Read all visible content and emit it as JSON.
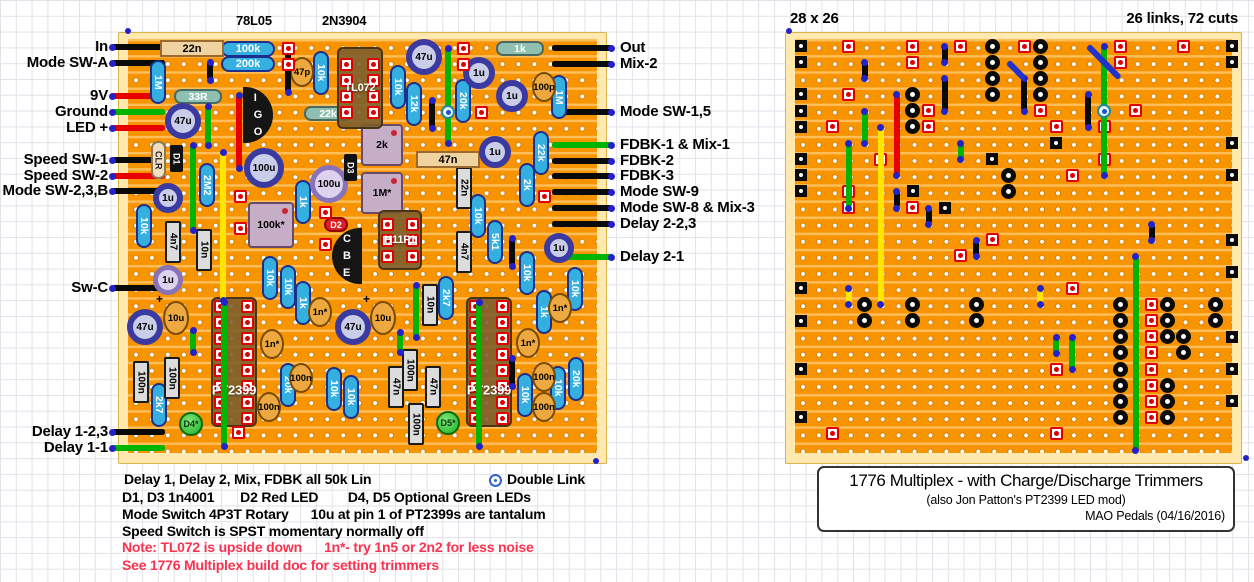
{
  "header": {
    "ic_label_1": "78L05",
    "ic_label_2": "2N3904",
    "board_size": "28 x 26",
    "links_cuts": "26 links, 72 cuts"
  },
  "left_labels": [
    {
      "text": "In",
      "y": 47,
      "color": "black"
    },
    {
      "text": "Mode SW-A",
      "y": 63,
      "color": "black"
    },
    {
      "text": "9V",
      "y": 96,
      "color": "red"
    },
    {
      "text": "Ground",
      "y": 112,
      "color": "green"
    },
    {
      "text": "LED +",
      "y": 128,
      "color": "red"
    },
    {
      "text": "Speed SW-1",
      "y": 160,
      "color": "black"
    },
    {
      "text": "Speed SW-2",
      "y": 176,
      "color": "red"
    },
    {
      "text": "Mode SW-2,3,B",
      "y": 191,
      "color": "black"
    },
    {
      "text": "Sw-C",
      "y": 288,
      "color": "black"
    },
    {
      "text": "Delay 1-2,3",
      "y": 432,
      "color": "black"
    },
    {
      "text": "Delay 1-1",
      "y": 448,
      "color": "green"
    }
  ],
  "right_labels": [
    {
      "text": "Out",
      "y": 48,
      "color": "black"
    },
    {
      "text": "Mix-2",
      "y": 64,
      "color": "black"
    },
    {
      "text": "Mode SW-1,5",
      "y": 112,
      "color": "black"
    },
    {
      "text": "FDBK-1 & Mix-1",
      "y": 145,
      "color": "green"
    },
    {
      "text": "FDBK-2",
      "y": 161,
      "color": "black"
    },
    {
      "text": "FDBK-3",
      "y": 176,
      "color": "black"
    },
    {
      "text": "Mode SW-9",
      "y": 192,
      "color": "black"
    },
    {
      "text": "Mode SW-8 & Mix-3",
      "y": 208,
      "color": "black"
    },
    {
      "text": "Delay 2-2,3",
      "y": 224,
      "color": "black"
    },
    {
      "text": "Delay 2-1",
      "y": 257,
      "color": "green"
    }
  ],
  "notes": {
    "line1": "Delay 1, Delay 2, Mix, FDBK all 50k Lin",
    "legend_double_link": "Double Link",
    "line2": "D1, D3 1n4001       D2 Red LED        D4, D5 Optional Green LEDs",
    "line3": "Mode Switch 4P3T Rotary      10u at pin 1 of PT2399s are tantalum",
    "line4": "Speed Switch is SPST momentary normally off",
    "line5": "Note: TL072 is upside down      1n*- try 1n5 or 2n2 for less noise",
    "line6": "See 1776 Multiplex build doc for setting trimmers"
  },
  "caption": {
    "title": "1776 Multiplex - with Charge/Discharge Trimmers",
    "subtitle": "(also Jon Patton's PT2399 LED mod)",
    "credit": "MAO Pedals (04/16/2016)"
  },
  "colors": {
    "board_margin": "#FFE9AE",
    "strip": "#F79400",
    "strip_gap": "#FFBE5C",
    "wire_black": "#0A0A0A",
    "wire_red": "#E80000",
    "wire_green": "#00B400",
    "wire_yellow": "#FFE500",
    "wire_blue": "#2233CC",
    "note_red": "#FA3250"
  },
  "left_board": {
    "x": 118,
    "y": 32,
    "w": 487,
    "h": 430,
    "components": [
      [
        "rh",
        "100k",
        248,
        49
      ],
      [
        "rh",
        "200k",
        248,
        64
      ],
      [
        "rg",
        "33R",
        198,
        96
      ],
      [
        "rg",
        "22k",
        328,
        113
      ],
      [
        "rg",
        "1k",
        520,
        48
      ],
      [
        "rv",
        "1M",
        158,
        82
      ],
      [
        "rv",
        "10k",
        321,
        73
      ],
      [
        "rv",
        "10k",
        398,
        87
      ],
      [
        "rv",
        "12k",
        414,
        104
      ],
      [
        "rv",
        "20k",
        463,
        101
      ],
      [
        "rv",
        "1M",
        559,
        97
      ],
      [
        "rv",
        "2M2",
        207,
        185
      ],
      [
        "rv",
        "10k",
        144,
        226
      ],
      [
        "rv",
        "1k",
        303,
        202
      ],
      [
        "rv",
        "22k",
        541,
        153
      ],
      [
        "rv",
        "2k",
        527,
        185
      ],
      [
        "rv",
        "10k",
        478,
        216
      ],
      [
        "rv",
        "5k1",
        495,
        242
      ],
      [
        "rv",
        "10k",
        270,
        278
      ],
      [
        "rv",
        "10k",
        288,
        287
      ],
      [
        "rv",
        "1k",
        303,
        303
      ],
      [
        "rv",
        "2k7",
        446,
        298
      ],
      [
        "rv",
        "10k",
        527,
        273
      ],
      [
        "rv",
        "1k",
        544,
        312
      ],
      [
        "rv",
        "10k",
        575,
        289
      ],
      [
        "rv",
        "20k",
        288,
        385
      ],
      [
        "rv",
        "10k",
        334,
        389
      ],
      [
        "rv",
        "10k",
        351,
        397
      ],
      [
        "rv",
        "2k7",
        159,
        405
      ],
      [
        "rv",
        "10k",
        525,
        395
      ],
      [
        "rv",
        "10k",
        558,
        388
      ],
      [
        "rv",
        "20k",
        576,
        379
      ],
      [
        "bx",
        "4n7",
        173,
        242
      ],
      [
        "bx",
        "10n",
        204,
        250
      ],
      [
        "bx",
        "22n",
        464,
        188
      ],
      [
        "bx",
        "4n7",
        464,
        252
      ],
      [
        "bx",
        "10n",
        430,
        305
      ],
      [
        "bx",
        "100n",
        141,
        382
      ],
      [
        "bx",
        "100n",
        172,
        378
      ],
      [
        "bx",
        "47n",
        396,
        387
      ],
      [
        "bx",
        "47n",
        433,
        387
      ],
      [
        "bx",
        "100n",
        410,
        370
      ],
      [
        "bx",
        "100n",
        416,
        424
      ],
      [
        "bt",
        "22n",
        192,
        48
      ],
      [
        "bt",
        "47n",
        448,
        159
      ],
      [
        "dc",
        "47p",
        302,
        72
      ],
      [
        "dc",
        "100p",
        544,
        87
      ],
      [
        "dc",
        "1n*",
        320,
        312
      ],
      [
        "dc",
        "1n*",
        272,
        344
      ],
      [
        "dc",
        "1n*",
        560,
        308
      ],
      [
        "dc",
        "1n*",
        528,
        343
      ],
      [
        "dc",
        "100n",
        301,
        378
      ],
      [
        "dc",
        "100n",
        269,
        407
      ],
      [
        "dc",
        "100n",
        544,
        377
      ],
      [
        "dc",
        "100n",
        544,
        407
      ],
      [
        "tn",
        "10u",
        176,
        318
      ],
      [
        "tn",
        "10u",
        383,
        318
      ],
      [
        "eb",
        "47u",
        183,
        121,
        36
      ],
      [
        "eb",
        "47u",
        424,
        57,
        36
      ],
      [
        "eb",
        "47u",
        145,
        327,
        36
      ],
      [
        "eb",
        "47u",
        353,
        327,
        36
      ],
      [
        "eb",
        "1u",
        168,
        198,
        30
      ],
      [
        "eb",
        "1u",
        479,
        73,
        32
      ],
      [
        "eb",
        "1u",
        512,
        96,
        32
      ],
      [
        "eb",
        "1u",
        495,
        152,
        32
      ],
      [
        "eb",
        "1u",
        559,
        248,
        30
      ],
      [
        "eb",
        "100u",
        264,
        168,
        40
      ],
      [
        "ep",
        "100u",
        329,
        184,
        38
      ],
      [
        "ep",
        "1u",
        168,
        280,
        30
      ],
      [
        "clr",
        "CLR",
        158,
        160
      ],
      [
        "db",
        "D1",
        176,
        159
      ],
      [
        "db",
        "D3",
        350,
        168
      ],
      [
        "dr",
        "D2",
        336,
        225
      ],
      [
        "ld",
        "D4*",
        191,
        424
      ],
      [
        "ld",
        "D5*",
        448,
        423
      ],
      [
        "to",
        "I G O",
        258,
        115,
        "left"
      ],
      [
        "to",
        "C B E",
        347,
        256,
        "right"
      ],
      [
        "tr",
        "2k",
        382,
        145,
        42
      ],
      [
        "tr",
        "1M*",
        382,
        193,
        42
      ],
      [
        "tr",
        "100k*",
        271,
        225,
        46
      ],
      [
        "ic",
        "TL072",
        360,
        88,
        46,
        82,
        4
      ],
      [
        "ic",
        "H11F1",
        400,
        240,
        44,
        60,
        3
      ],
      [
        "ic",
        "PT2399",
        234,
        362,
        46,
        130,
        8
      ],
      [
        "ic",
        "PT2399",
        489,
        362,
        46,
        130,
        8
      ]
    ],
    "wires": [
      [
        239,
        95,
        168,
        "red"
      ],
      [
        223,
        152,
        300,
        "yellow"
      ],
      [
        208,
        106,
        145,
        "green"
      ],
      [
        193,
        145,
        230,
        "green"
      ],
      [
        193,
        330,
        352,
        "green"
      ],
      [
        400,
        332,
        352,
        "green"
      ],
      [
        448,
        48,
        143,
        "green",
        112
      ],
      [
        416,
        285,
        337,
        "green"
      ],
      [
        224,
        302,
        446,
        "green"
      ],
      [
        479,
        302,
        446,
        "green"
      ],
      [
        288,
        45,
        92,
        "black"
      ],
      [
        210,
        62,
        80,
        "black"
      ],
      [
        432,
        100,
        128,
        "black"
      ],
      [
        512,
        238,
        266,
        "black"
      ],
      [
        512,
        358,
        386,
        "black"
      ]
    ],
    "pads": [
      [
        288,
        48
      ],
      [
        288,
        64
      ],
      [
        463,
        48
      ],
      [
        463,
        64
      ],
      [
        481,
        112
      ],
      [
        240,
        196
      ],
      [
        240,
        228
      ],
      [
        325,
        212
      ],
      [
        325,
        244
      ],
      [
        544,
        196
      ],
      [
        238,
        432
      ]
    ]
  },
  "right_board": {
    "x": 785,
    "y": 32,
    "w": 455,
    "h": 430,
    "grid": {
      "cols": 28,
      "rows": 26
    },
    "squares": [
      [
        0,
        0
      ],
      [
        0,
        1
      ],
      [
        0,
        3
      ],
      [
        0,
        4
      ],
      [
        0,
        5
      ],
      [
        0,
        7
      ],
      [
        0,
        8
      ],
      [
        0,
        9
      ],
      [
        0,
        15
      ],
      [
        0,
        17
      ],
      [
        0,
        20
      ],
      [
        0,
        23
      ],
      [
        27,
        0
      ],
      [
        27,
        1
      ],
      [
        27,
        6
      ],
      [
        27,
        8
      ],
      [
        27,
        12
      ],
      [
        27,
        14
      ],
      [
        27,
        18
      ],
      [
        27,
        20
      ],
      [
        27,
        22
      ],
      [
        16,
        6
      ],
      [
        9,
        10
      ],
      [
        7,
        9
      ],
      [
        12,
        7
      ]
    ],
    "cuts": [
      [
        12,
        0
      ],
      [
        12,
        1
      ],
      [
        12,
        2
      ],
      [
        12,
        3
      ],
      [
        15,
        0
      ],
      [
        15,
        1
      ],
      [
        15,
        2
      ],
      [
        15,
        3
      ],
      [
        7,
        3
      ],
      [
        7,
        4
      ],
      [
        7,
        5
      ],
      [
        13,
        8
      ],
      [
        13,
        9
      ],
      [
        4,
        16
      ],
      [
        4,
        17
      ],
      [
        7,
        16
      ],
      [
        7,
        17
      ],
      [
        11,
        16
      ],
      [
        11,
        17
      ],
      [
        20,
        16
      ],
      [
        20,
        17
      ],
      [
        20,
        18
      ],
      [
        20,
        19
      ],
      [
        20,
        20
      ],
      [
        20,
        21
      ],
      [
        20,
        22
      ],
      [
        20,
        23
      ],
      [
        23,
        16
      ],
      [
        23,
        17
      ],
      [
        23,
        18
      ],
      [
        23,
        21
      ],
      [
        23,
        22
      ],
      [
        23,
        23
      ],
      [
        24,
        18
      ],
      [
        24,
        19
      ],
      [
        26,
        16
      ],
      [
        26,
        17
      ]
    ],
    "pads": [
      [
        3,
        0
      ],
      [
        7,
        0
      ],
      [
        10,
        0
      ],
      [
        14,
        0
      ],
      [
        20,
        0
      ],
      [
        24,
        0
      ],
      [
        7,
        1
      ],
      [
        20,
        1
      ],
      [
        3,
        3
      ],
      [
        21,
        4
      ],
      [
        15,
        4
      ],
      [
        8,
        4
      ],
      [
        8,
        5
      ],
      [
        2,
        5
      ],
      [
        16,
        5
      ],
      [
        19,
        5
      ],
      [
        5,
        7
      ],
      [
        19,
        7
      ],
      [
        17,
        8
      ],
      [
        3,
        9
      ],
      [
        3,
        10
      ],
      [
        7,
        10
      ],
      [
        10,
        13
      ],
      [
        12,
        12
      ],
      [
        17,
        15
      ],
      [
        16,
        20
      ],
      [
        16,
        24
      ],
      [
        2,
        24
      ],
      [
        22,
        16
      ],
      [
        22,
        17
      ],
      [
        22,
        18
      ],
      [
        22,
        19
      ],
      [
        22,
        20
      ],
      [
        22,
        21
      ],
      [
        22,
        22
      ],
      [
        22,
        23
      ]
    ],
    "links": [
      {
        "c": 4,
        "r1": 1,
        "r2": 2,
        "color": "black"
      },
      {
        "c": 9,
        "r1": 0,
        "r2": 1,
        "color": "black"
      },
      {
        "c": 9,
        "r1": 2,
        "r2": 4,
        "color": "black"
      },
      {
        "c": 14,
        "r1": 2,
        "r2": 4,
        "color": "black"
      },
      {
        "c": 18,
        "r1": 3,
        "r2": 5,
        "color": "black"
      },
      {
        "c": 6,
        "r1": 9,
        "r2": 10,
        "color": "black"
      },
      {
        "c": 8,
        "r1": 10,
        "r2": 11,
        "color": "black"
      },
      {
        "c": 11,
        "r1": 12,
        "r2": 13,
        "color": "black"
      },
      {
        "c": 22,
        "r1": 11,
        "r2": 12,
        "color": "black"
      },
      {
        "c": 3,
        "r1": 6,
        "r2": 10,
        "color": "green"
      },
      {
        "c": 4,
        "r1": 4,
        "r2": 6,
        "color": "green"
      },
      {
        "c": 10,
        "r1": 6,
        "r2": 7,
        "color": "green"
      },
      {
        "c": 19,
        "r1": 0,
        "r2": 8,
        "color": "green",
        "dbl": 4
      },
      {
        "c": 21,
        "r1": 13,
        "r2": 25,
        "color": "green"
      },
      {
        "c": 17,
        "r1": 18,
        "r2": 20,
        "color": "green"
      },
      {
        "c": 16,
        "r1": 18,
        "r2": 19,
        "color": "green"
      },
      {
        "c": 6,
        "r1": 3,
        "r2": 8,
        "color": "red"
      },
      {
        "c": 5,
        "r1": 5,
        "r2": 16,
        "color": "yellow"
      },
      {
        "c": 3,
        "r1": 15,
        "r2": 16,
        "color": "yellow"
      },
      {
        "c": 15,
        "r1": 15,
        "r2": 16,
        "color": "yellow"
      }
    ],
    "diagonals": [
      {
        "c1": 18,
        "r1": 0,
        "c2": 20,
        "r2": 2,
        "color": "blue"
      },
      {
        "c1": 13,
        "r1": 1,
        "c2": 14,
        "r2": 2,
        "color": "blue"
      }
    ]
  },
  "corner_dots": [
    [
      128,
      31
    ],
    [
      596,
      461
    ],
    [
      789,
      31
    ],
    [
      1246,
      458
    ]
  ]
}
